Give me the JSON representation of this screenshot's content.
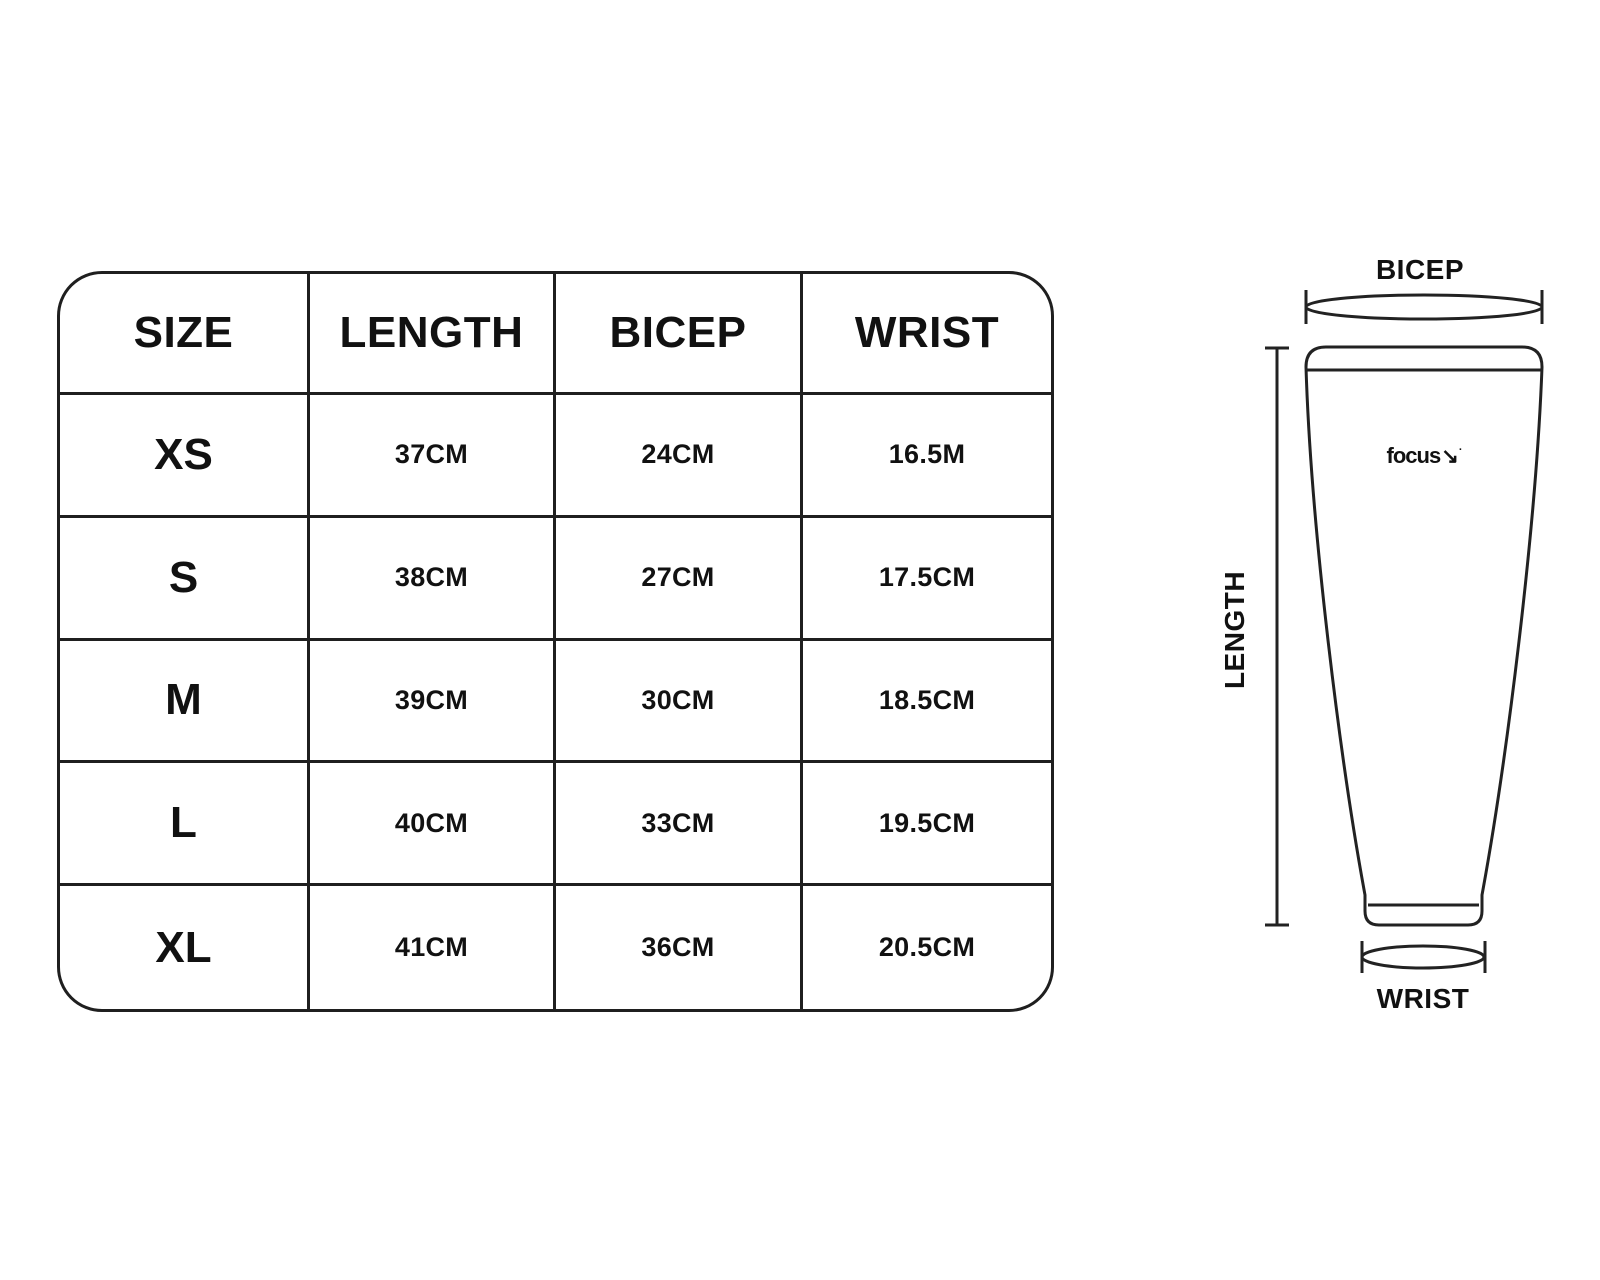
{
  "table": {
    "headers": [
      "SIZE",
      "LENGTH",
      "BICEP",
      "WRIST"
    ],
    "rows": [
      {
        "size": "XS",
        "length": "37CM",
        "bicep": "24CM",
        "wrist": "16.5M"
      },
      {
        "size": "S",
        "length": "38CM",
        "bicep": "27CM",
        "wrist": "17.5CM"
      },
      {
        "size": "M",
        "length": "39CM",
        "bicep": "30CM",
        "wrist": "18.5CM"
      },
      {
        "size": "L",
        "length": "40CM",
        "bicep": "33CM",
        "wrist": "19.5CM"
      },
      {
        "size": "XL",
        "length": "41CM",
        "bicep": "36CM",
        "wrist": "20.5CM"
      }
    ]
  },
  "diagram": {
    "bicep_label": "BICEP",
    "length_label": "LENGTH",
    "wrist_label": "WRIST",
    "brand": "focus",
    "brand_arrow": "↘",
    "brand_mark": "·"
  },
  "colors": {
    "line": "#222222",
    "text": "#111111",
    "background": "#ffffff"
  }
}
